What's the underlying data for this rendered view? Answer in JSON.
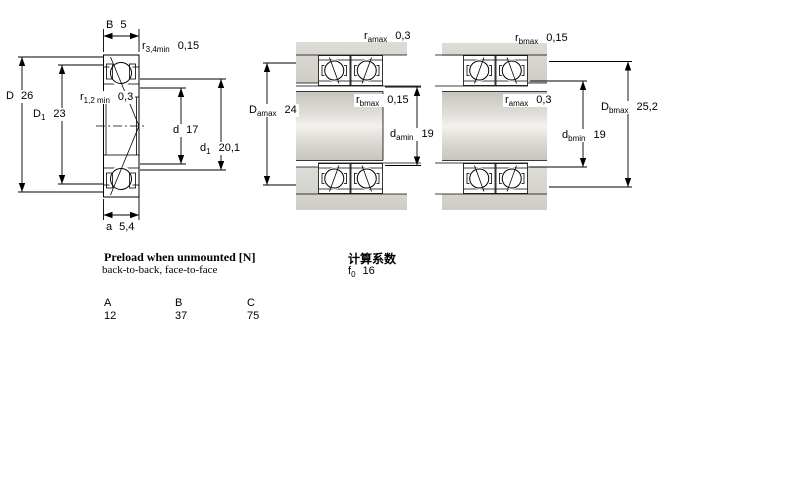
{
  "drawings": {
    "section": {
      "name": "bearing cross section",
      "dims": {
        "B": {
          "base": "B",
          "sub": "",
          "value": "5"
        },
        "r34": {
          "base": "r",
          "sub": "3,4min",
          "value": "0,15"
        },
        "D": {
          "base": "D",
          "sub": "",
          "value": "26"
        },
        "D1": {
          "base": "D",
          "sub": "1",
          "value": "23"
        },
        "r12": {
          "base": "r",
          "sub": "1,2 min",
          "value": "0,3"
        },
        "d": {
          "base": "d",
          "sub": "",
          "value": "17"
        },
        "d1": {
          "base": "d",
          "sub": "1",
          "value": "20,1"
        },
        "a": {
          "base": "a",
          "sub": "",
          "value": "5,4"
        }
      }
    },
    "arrangement_a": {
      "name": "abutment dimensions a",
      "dims": {
        "ramax": {
          "base": "r",
          "sub": "amax",
          "value": "0,3"
        },
        "Damax": {
          "base": "D",
          "sub": "amax",
          "value": "24"
        },
        "rbmax": {
          "base": "r",
          "sub": "bmax",
          "value": "0,15"
        },
        "damin": {
          "base": "d",
          "sub": "amin",
          "value": "19"
        }
      }
    },
    "arrangement_b": {
      "name": "abutment dimensions b",
      "dims": {
        "rbmax": {
          "base": "r",
          "sub": "bmax",
          "value": "0,15"
        },
        "ramax": {
          "base": "r",
          "sub": "amax",
          "value": "0,3"
        },
        "Dbmax": {
          "base": "D",
          "sub": "bmax",
          "value": "25,2"
        },
        "dbmin": {
          "base": "d",
          "sub": "bmin",
          "value": "19"
        }
      }
    }
  },
  "preload": {
    "title": "Preload when unmounted [N]",
    "subtitle": "back-to-back, face-to-face",
    "columns": [
      "A",
      "B",
      "C"
    ],
    "values": [
      "12",
      "37",
      "75"
    ]
  },
  "calculation": {
    "title": "计算系数",
    "f0": {
      "base": "f",
      "sub": "0",
      "value": "16"
    }
  },
  "colors": {
    "ring_fill": "#ccd7f0",
    "ring_hatch": "#96a6cf",
    "metal_gray": "#d6d4ce",
    "metal_light": "#f4f3f0",
    "line": "#000000"
  }
}
